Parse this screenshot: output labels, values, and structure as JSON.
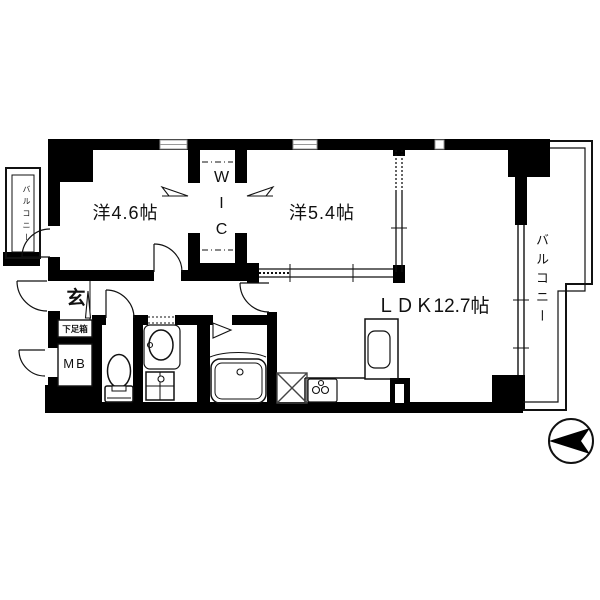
{
  "floor_plan": {
    "title": "apartment-floor-plan",
    "rooms": {
      "west_room_small": {
        "label": "洋4.6帖"
      },
      "west_room_large": {
        "label": "洋5.4帖"
      },
      "wic": {
        "label": "WIC"
      },
      "ldk": {
        "label": "ＬＤＫ12.7帖"
      },
      "genkan": {
        "label": "玄"
      },
      "shoe_box": {
        "label": "下足箱"
      },
      "meter_box": {
        "label": "MB"
      },
      "balcony_left": {
        "label": "バルコニー"
      },
      "balcony_right": {
        "label": "バルコニー"
      }
    },
    "icons": {
      "compass": "north-arrow-pointing-left",
      "toilet": "toilet-plan-symbol",
      "washbasin": "washbasin-oval-symbol",
      "washer_pan": "washing-machine-pan-symbol",
      "bathtub": "bathtub-plan-symbol",
      "kitchen_sink": "kitchen-sink-symbol",
      "stove": "three-burner-stove-symbol",
      "appliance_space": "x-crossed-box-symbol",
      "wic_doors": "folding-door-arrow-symbols",
      "step": "genkan-step-triangle"
    },
    "colors": {
      "wall": "#000000",
      "line": "#111111",
      "background": "#ffffff"
    }
  }
}
